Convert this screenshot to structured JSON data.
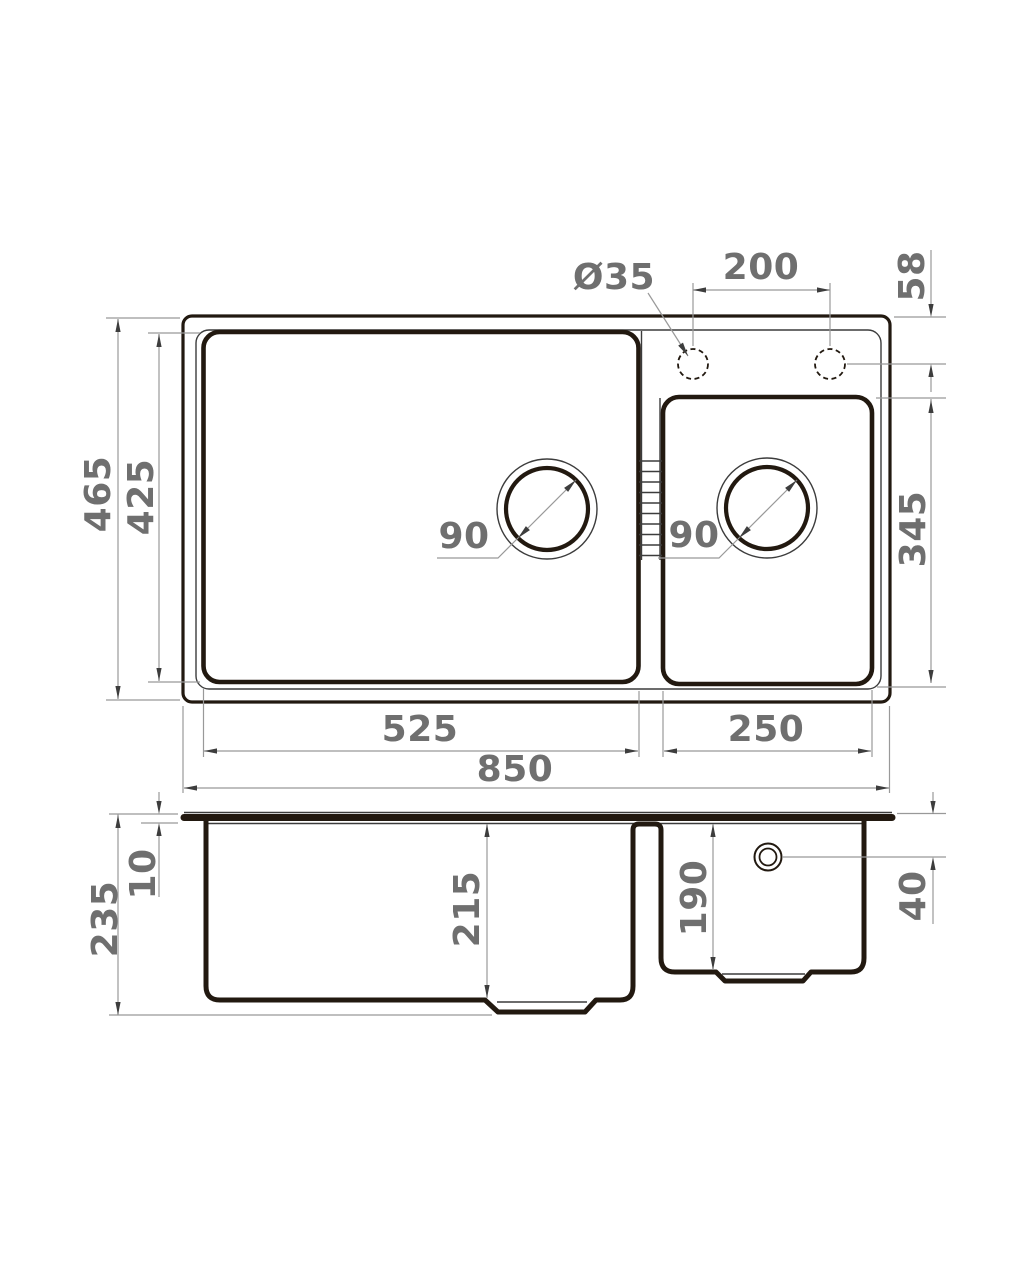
{
  "colors": {
    "page_bg": "#ffffff",
    "outline": "#221910",
    "thin_line": "#3c3c3c",
    "dim_line": "#999999",
    "arrow": "#3d3d3d",
    "label": "#6f6f6f"
  },
  "drawing": {
    "kind": "kitchen sink dimension drawing",
    "views": [
      "top view",
      "front section view"
    ]
  },
  "top_view": {
    "labels": {
      "faucet_diameter": "Ø35",
      "hole_spacing": "200",
      "hole_edge_offset": "58",
      "overall_front_to_back": "465",
      "main_bowl_front_to_back": "425",
      "main_drain_diameter": "90",
      "second_drain_diameter": "90",
      "second_bowl_front_to_back": "345",
      "main_bowl_width": "525",
      "second_bowl_width": "250",
      "overall_width": "850"
    }
  },
  "section_view": {
    "labels": {
      "rim_thickness": "10",
      "overall_depth": "235",
      "main_bowl_inner_depth": "215",
      "second_bowl_inner_depth": "190",
      "overflow_offset": "40"
    }
  }
}
